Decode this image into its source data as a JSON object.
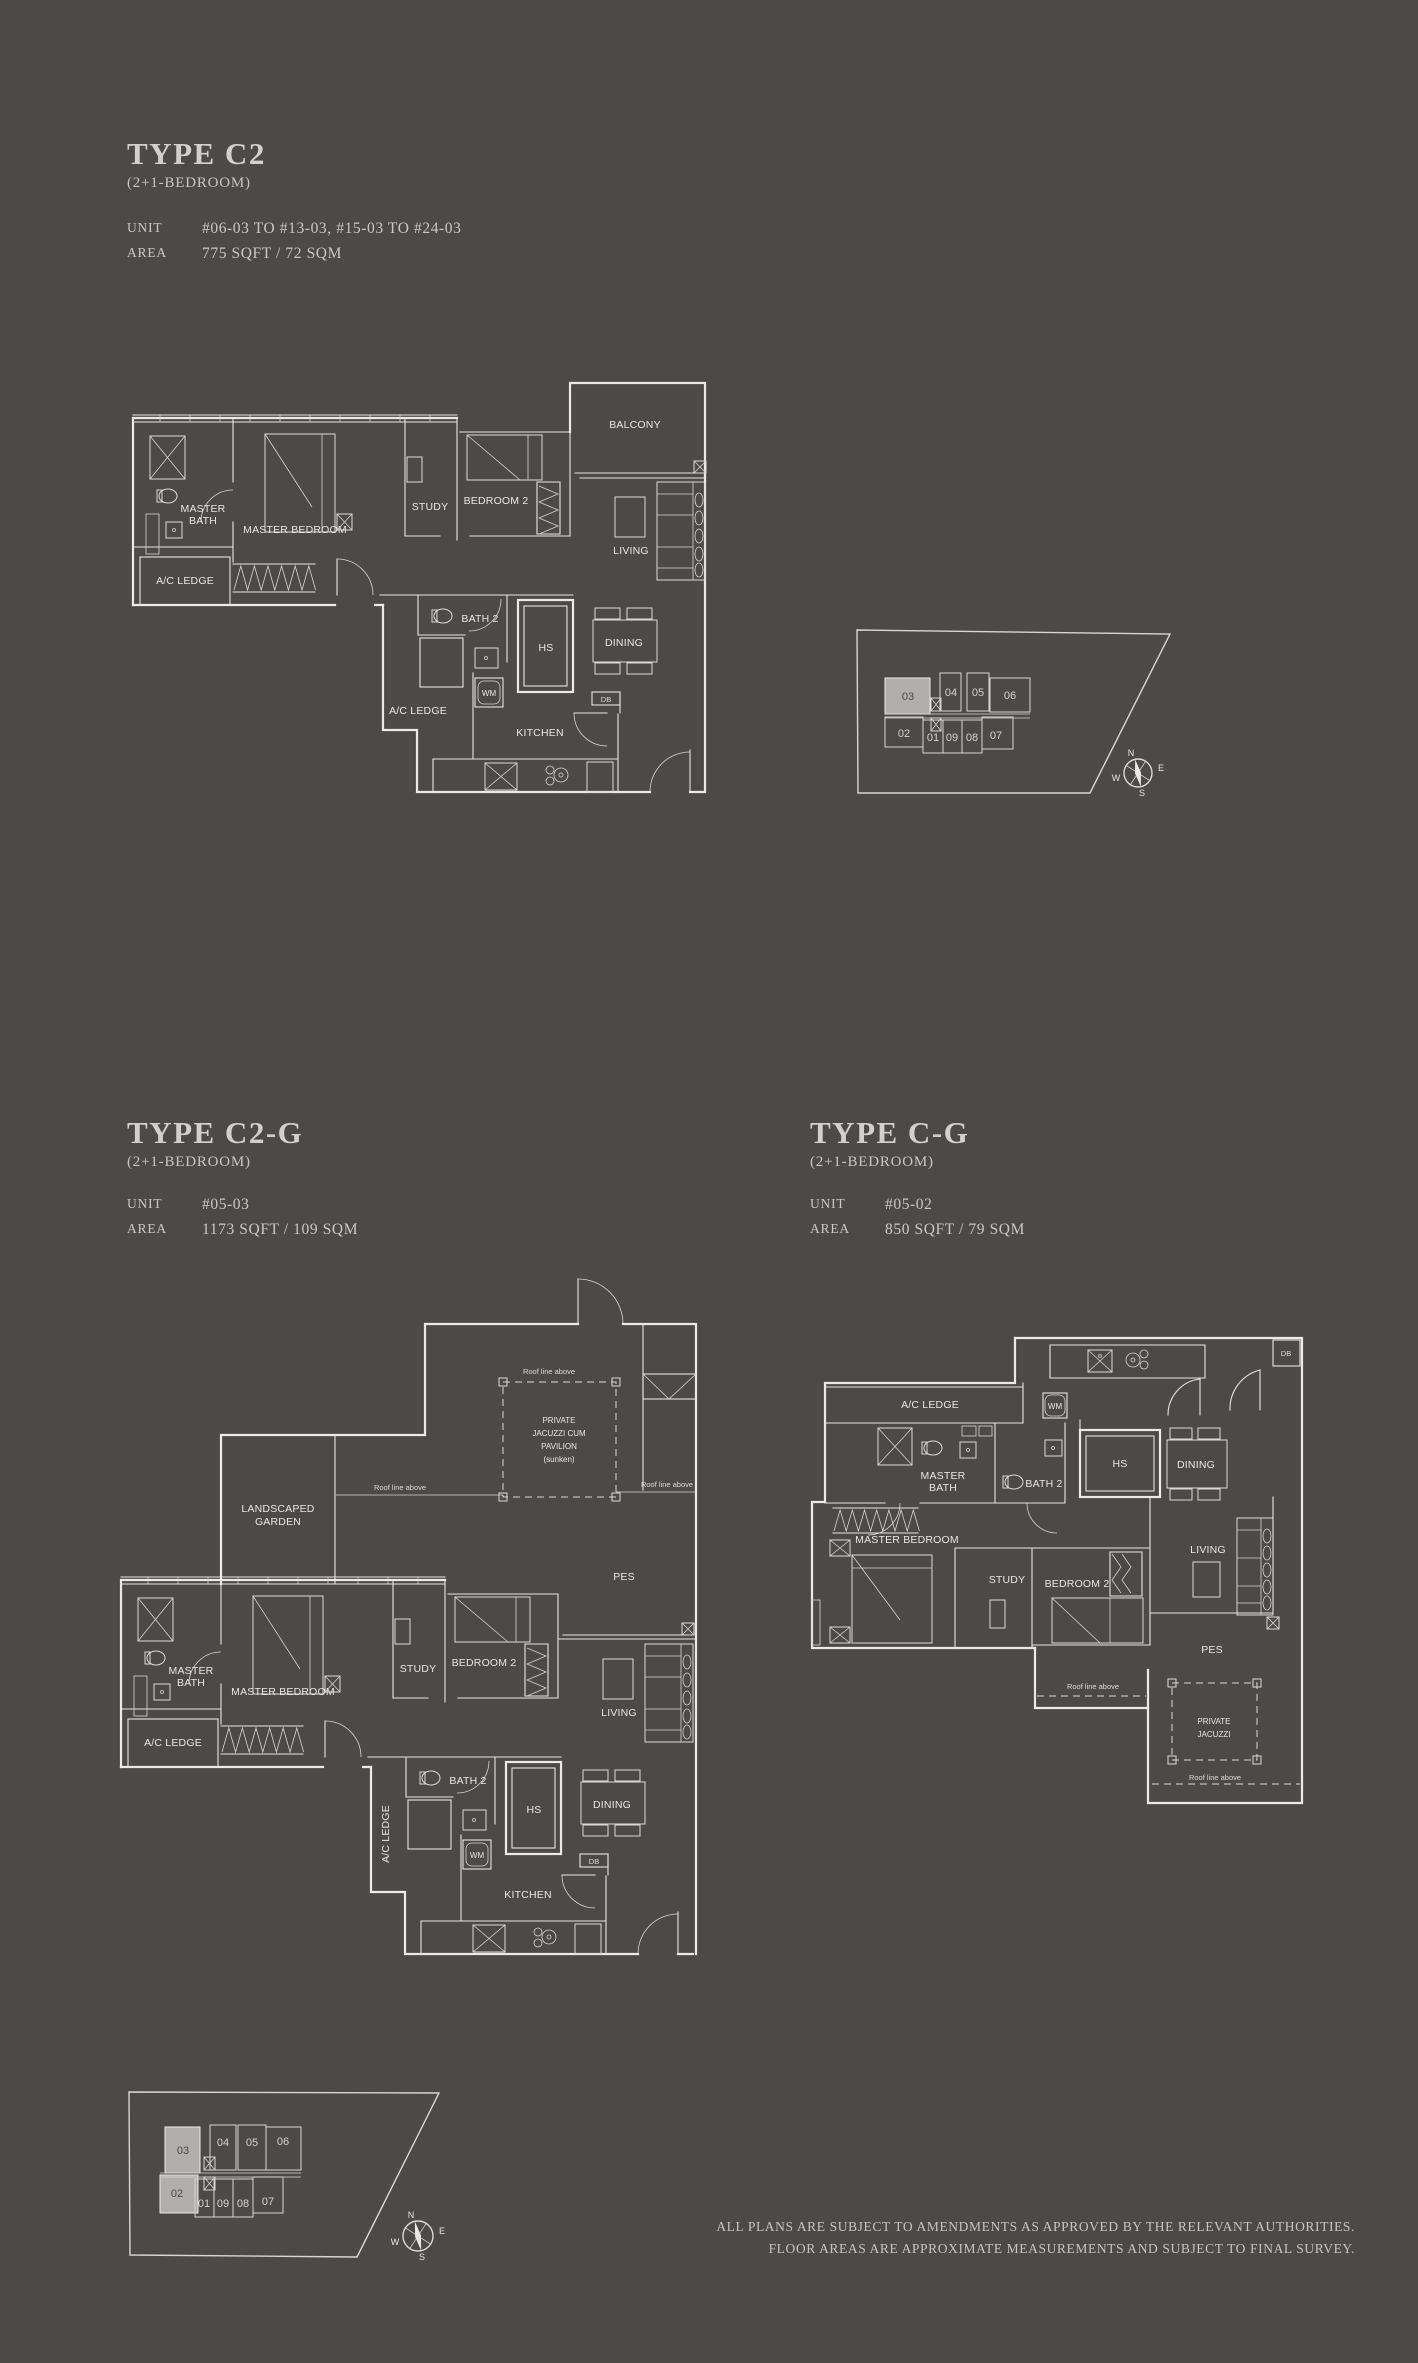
{
  "page": {
    "background": "#4b4a48",
    "line_color": "#eceae6",
    "highlight_fill": "#b1afac"
  },
  "plans": {
    "c2": {
      "title": "TYPE C2",
      "subtitle": "(2+1-BEDROOM)",
      "unit_label": "UNIT",
      "unit_value": "#06-03 TO #13-03, #15-03 TO #24-03",
      "area_label": "AREA",
      "area_value": "775 SQFT / 72 SQM",
      "rooms": {
        "balcony": "BALCONY",
        "master_bath_1": "MASTER",
        "master_bath_2": "BATH",
        "master_bedroom": "MASTER BEDROOM",
        "study": "STUDY",
        "bedroom2": "BEDROOM 2",
        "living": "LIVING",
        "ac_ledge_left": "A/C LEDGE",
        "bath2": "BATH 2",
        "hs": "HS",
        "dining": "DINING",
        "wm": "WM",
        "db": "DB",
        "ac_ledge_bottom": "A/C LEDGE",
        "kitchen": "KITCHEN"
      }
    },
    "c2g": {
      "title": "TYPE C2-G",
      "subtitle": "(2+1-BEDROOM)",
      "unit_label": "UNIT",
      "unit_value": "#05-03",
      "area_label": "AREA",
      "area_value": "1173 SQFT / 109 SQM",
      "rooms": {
        "roof_top": "Roof line above",
        "roof_mid": "Roof line above",
        "roof_right": "Roof line above",
        "jacuzzi_1": "PRIVATE",
        "jacuzzi_2": "JACUZZI CUM",
        "jacuzzi_3": "PAVILION",
        "jacuzzi_4": "(sunken)",
        "garden_1": "LANDSCAPED",
        "garden_2": "GARDEN",
        "pes": "PES",
        "master_bath_1": "MASTER",
        "master_bath_2": "BATH",
        "master_bedroom": "MASTER BEDROOM",
        "study": "STUDY",
        "bedroom2": "BEDROOM 2",
        "living": "LIVING",
        "ac_ledge_left": "A/C LEDGE",
        "ac_ledge_bottom": "A/C LEDGE",
        "bath2": "BATH 2",
        "hs": "HS",
        "dining": "DINING",
        "wm": "WM",
        "db": "DB",
        "kitchen": "KITCHEN"
      }
    },
    "cg": {
      "title": "TYPE C-G",
      "subtitle": "(2+1-BEDROOM)",
      "unit_label": "UNIT",
      "unit_value": "#05-02",
      "area_label": "AREA",
      "area_value": "850 SQFT / 79 SQM",
      "rooms": {
        "ac_ledge": "A/C LEDGE",
        "wm": "WM",
        "db": "DB",
        "master_bath_1": "MASTER",
        "master_bath_2": "BATH",
        "bath2": "BATH 2",
        "hs": "HS",
        "dining": "DINING",
        "master_bedroom": "MASTER BEDROOM",
        "study": "STUDY",
        "bedroom2": "BEDROOM 2",
        "living": "LIVING",
        "pes": "PES",
        "roof_mid": "Roof line above",
        "roof_bottom": "Roof line above",
        "jacuzzi_1": "PRIVATE",
        "jacuzzi_2": "JACUZZI"
      }
    }
  },
  "keyplan1": {
    "units": [
      {
        "label": "03",
        "highlighted": true
      },
      {
        "label": "04"
      },
      {
        "label": "05"
      },
      {
        "label": "06"
      },
      {
        "label": "02"
      },
      {
        "label": "01"
      },
      {
        "label": "09"
      },
      {
        "label": "08"
      },
      {
        "label": "07"
      }
    ],
    "compass": {
      "n": "N",
      "e": "E",
      "s": "S",
      "w": "W"
    }
  },
  "keyplan2": {
    "units": [
      {
        "label": "03",
        "highlighted": true
      },
      {
        "label": "04"
      },
      {
        "label": "05"
      },
      {
        "label": "06"
      },
      {
        "label": "02",
        "highlighted": true
      },
      {
        "label": "01"
      },
      {
        "label": "09"
      },
      {
        "label": "08"
      },
      {
        "label": "07"
      }
    ],
    "compass": {
      "n": "N",
      "e": "E",
      "s": "S",
      "w": "W"
    }
  },
  "disclaimer": {
    "line1": "ALL PLANS ARE SUBJECT TO AMENDMENTS AS APPROVED BY THE RELEVANT AUTHORITIES.",
    "line2": "FLOOR AREAS ARE APPROXIMATE MEASUREMENTS AND SUBJECT TO FINAL SURVEY."
  }
}
